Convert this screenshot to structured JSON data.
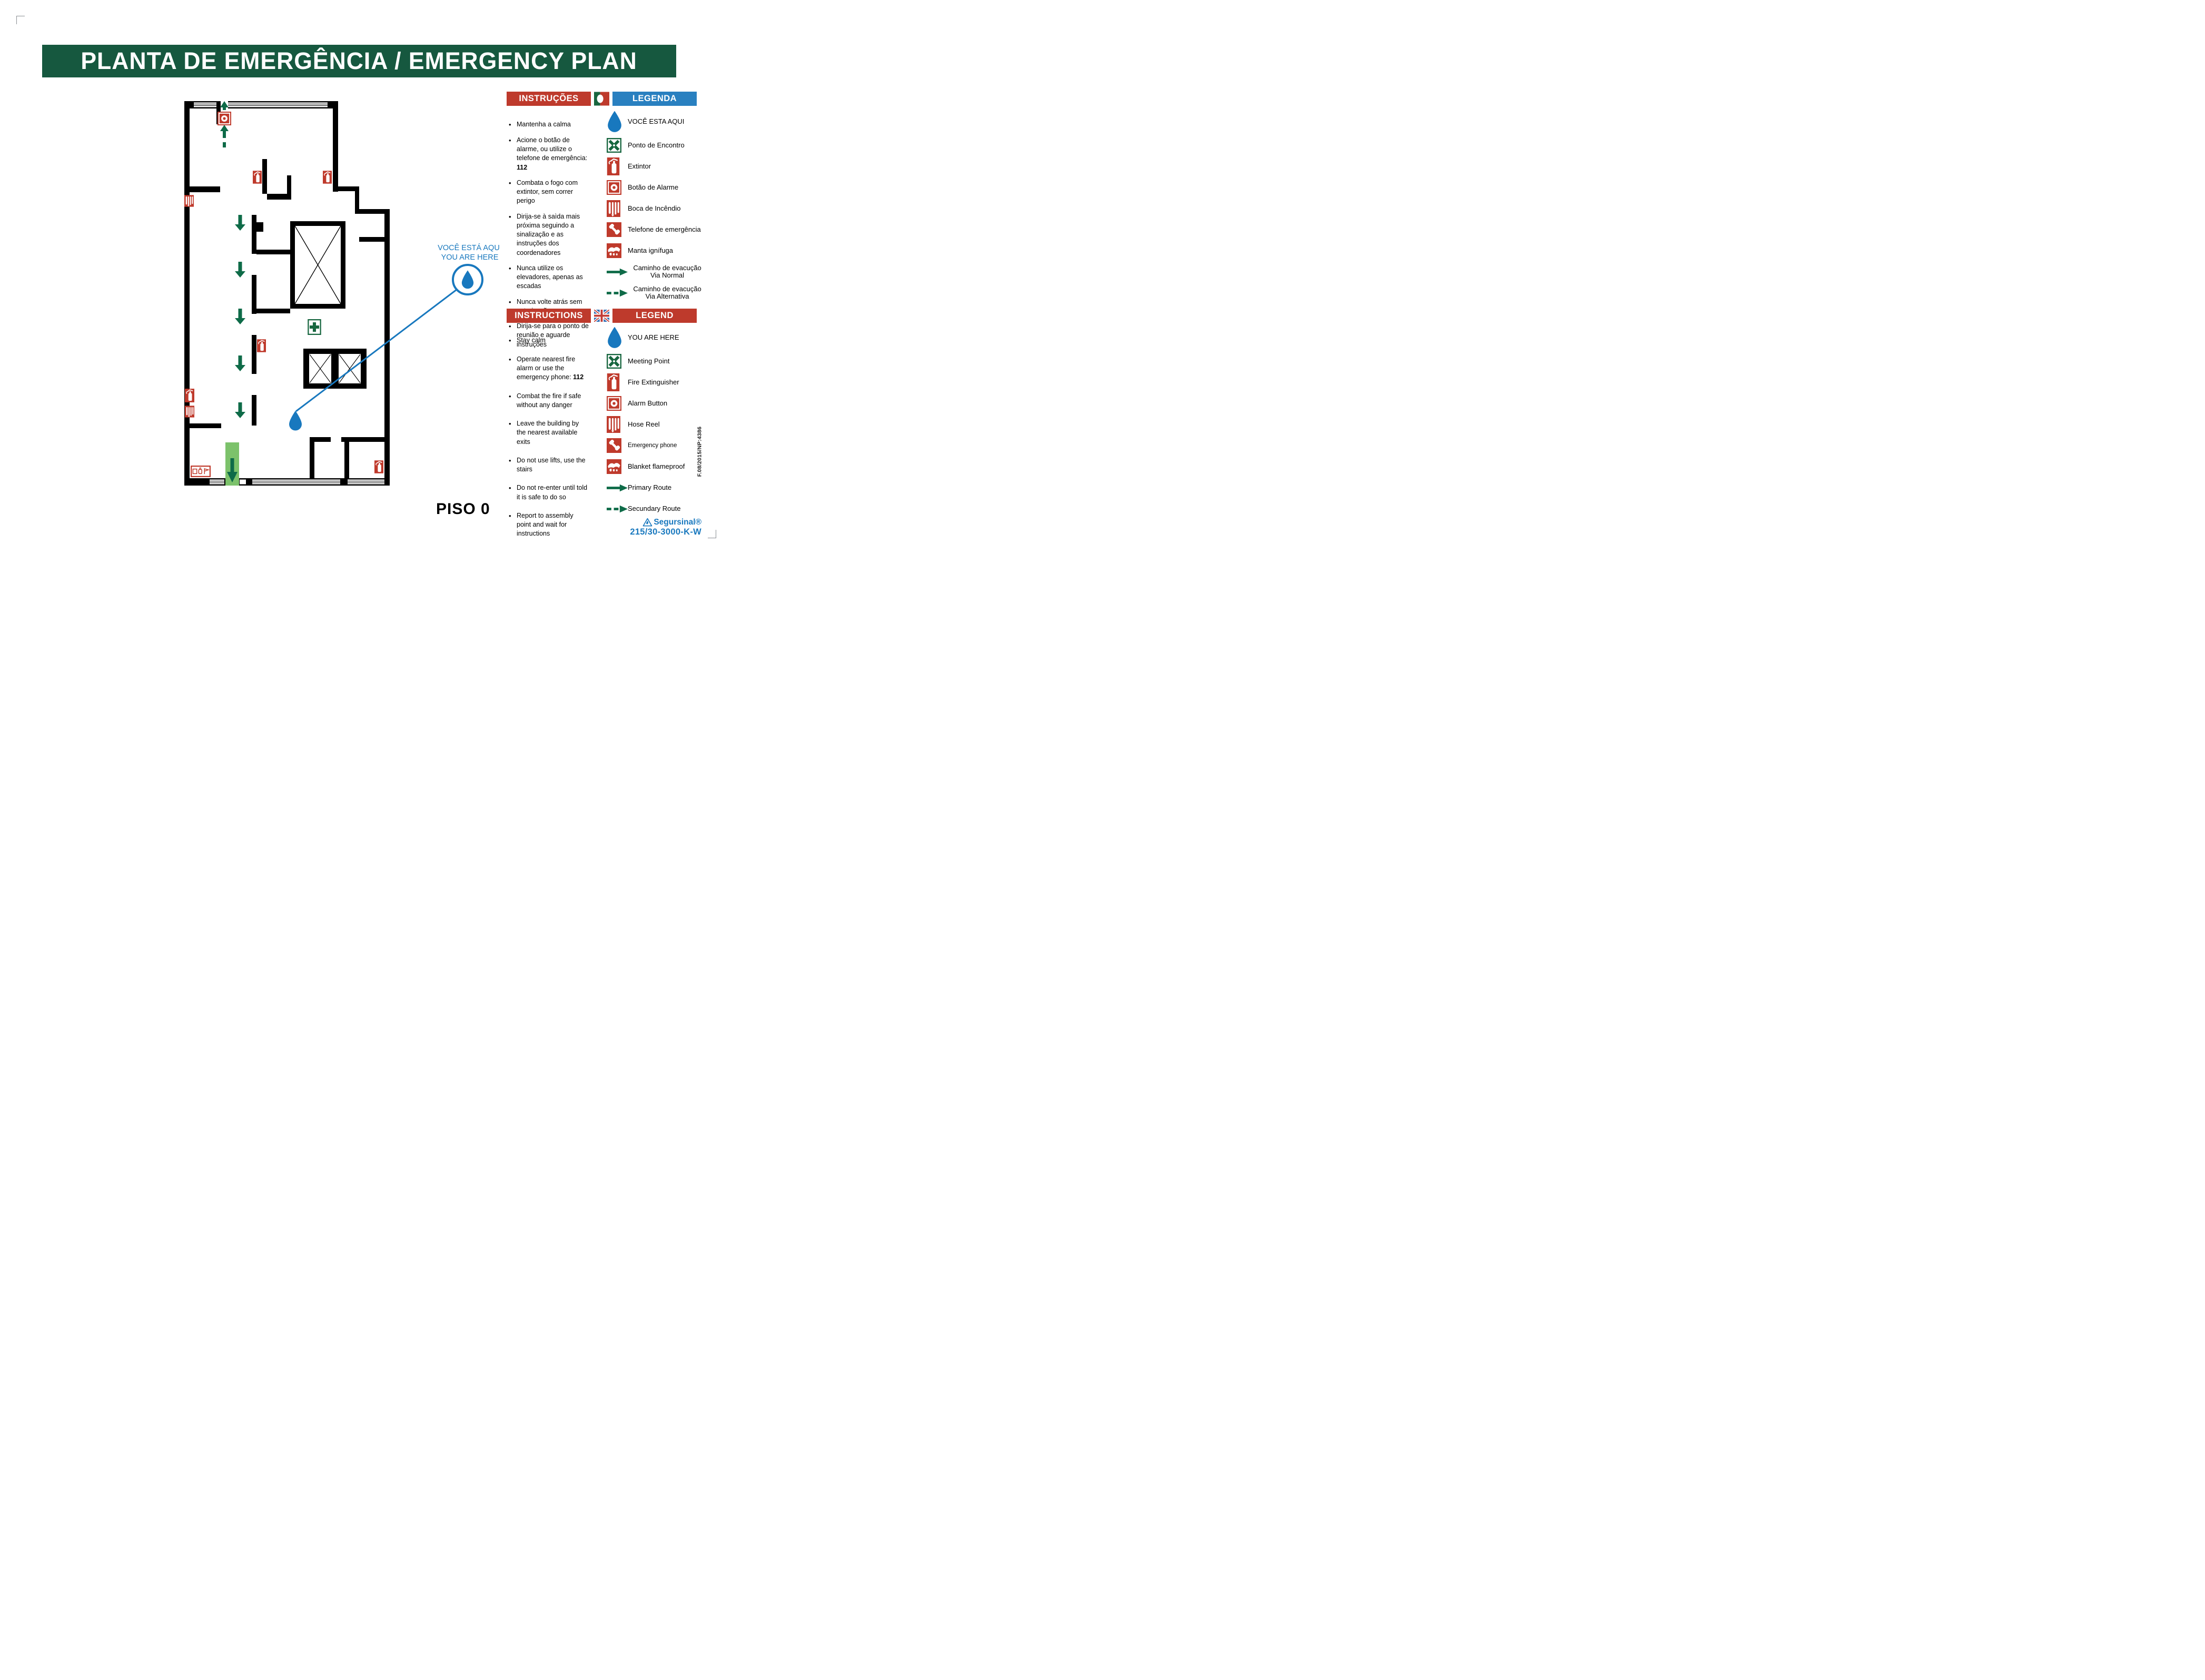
{
  "header": {
    "title": "PLANTA DE EMERGÊNCIA / EMERGENCY PLAN"
  },
  "floor": {
    "label": "PISO 0"
  },
  "you_are_here_callout": {
    "line1": "VOCÊ ESTÁ AQUI",
    "line2": "YOU ARE HERE"
  },
  "pt": {
    "instructions_title": "INSTRUÇÕES",
    "legend_title": "LEGENDA",
    "instructions": [
      {
        "text": "Mantenha a calma",
        "bold": ""
      },
      {
        "text": "Acione o botão de alarme, ou utilize o telefone de emergência: ",
        "bold": "112"
      },
      {
        "text": "Combata o fogo com extintor, sem correr perigo",
        "bold": ""
      },
      {
        "text": "Dirija-se à saìda mais próxima seguindo a sinalização e as instruções dos coordenadores",
        "bold": ""
      },
      {
        "text": "Nunca utilize os elevadores, apenas as escadas",
        "bold": ""
      },
      {
        "text": "Nunca volte atrás sem autorização",
        "bold": ""
      },
      {
        "text": "Dirija-se para o ponto de reunião e aguarde instruções",
        "bold": ""
      }
    ],
    "legend": [
      {
        "icon": "you-are-here-drop-icon",
        "label": "VOCÊ ESTA AQUI",
        "label2": ""
      },
      {
        "icon": "meeting-point-icon",
        "label": "Ponto de Encontro",
        "label2": ""
      },
      {
        "icon": "fire-extinguisher-icon",
        "label": "Extintor",
        "label2": ""
      },
      {
        "icon": "alarm-button-icon",
        "label": "Botão de Alarme",
        "label2": ""
      },
      {
        "icon": "hose-reel-icon",
        "label": "Boca de Incêndio",
        "label2": ""
      },
      {
        "icon": "emergency-phone-icon",
        "label": "Telefone de emergência",
        "label2": ""
      },
      {
        "icon": "fire-blanket-icon",
        "label": "Manta ignífuga",
        "label2": ""
      },
      {
        "icon": "route-solid-arrow-icon",
        "label": "Caminho de evacução",
        "label2": "Via Normal"
      },
      {
        "icon": "route-dashed-arrow-icon",
        "label": "Caminho de evacução",
        "label2": "Via Alternativa"
      }
    ]
  },
  "en": {
    "instructions_title": "INSTRUCTIONS",
    "legend_title": "LEGEND",
    "instructions": [
      {
        "text": "Stay calm",
        "bold": ""
      },
      {
        "text": "Operate nearest fire alarm or use the emergency phone: ",
        "bold": "112"
      },
      {
        "text": "Combat the fire if safe without any danger",
        "bold": ""
      },
      {
        "text": "Leave the building by the nearest available exits",
        "bold": ""
      },
      {
        "text": "Do not use lifts, use the stairs",
        "bold": ""
      },
      {
        "text": "Do not re-enter until told it is safe to do so",
        "bold": ""
      },
      {
        "text": "Report to assembly point and wait for instructions",
        "bold": ""
      }
    ],
    "legend": [
      {
        "icon": "you-are-here-drop-icon",
        "label": "YOU ARE HERE",
        "label2": ""
      },
      {
        "icon": "meeting-point-icon",
        "label": "Meeting Point",
        "label2": ""
      },
      {
        "icon": "fire-extinguisher-icon",
        "label": "Fire Extinguisher",
        "label2": ""
      },
      {
        "icon": "alarm-button-icon",
        "label": "Alarm Button",
        "label2": ""
      },
      {
        "icon": "hose-reel-icon",
        "label": "Hose Reel",
        "label2": ""
      },
      {
        "icon": "emergency-phone-icon",
        "label": "Emergency phone",
        "label2": ""
      },
      {
        "icon": "fire-blanket-icon",
        "label": "Blanket flameproof",
        "label2": ""
      },
      {
        "icon": "route-solid-arrow-icon",
        "label": "Primary Route",
        "label2": ""
      },
      {
        "icon": "route-dashed-arrow-icon",
        "label": "Secundary Route",
        "label2": ""
      }
    ]
  },
  "footer": {
    "brand": "Segursinal®",
    "model": "215/30-3000-K-W",
    "side_code": "F.08/2015/NP:4386"
  },
  "colors": {
    "header_green": "#16583F",
    "banner_red": "#BE3A2C",
    "banner_blue": "#2980C0",
    "marker_blue": "#1878BE",
    "route_green": "#0E6B48",
    "exit_strip_green": "#7CC26B",
    "icon_red": "#BF3A2C"
  }
}
